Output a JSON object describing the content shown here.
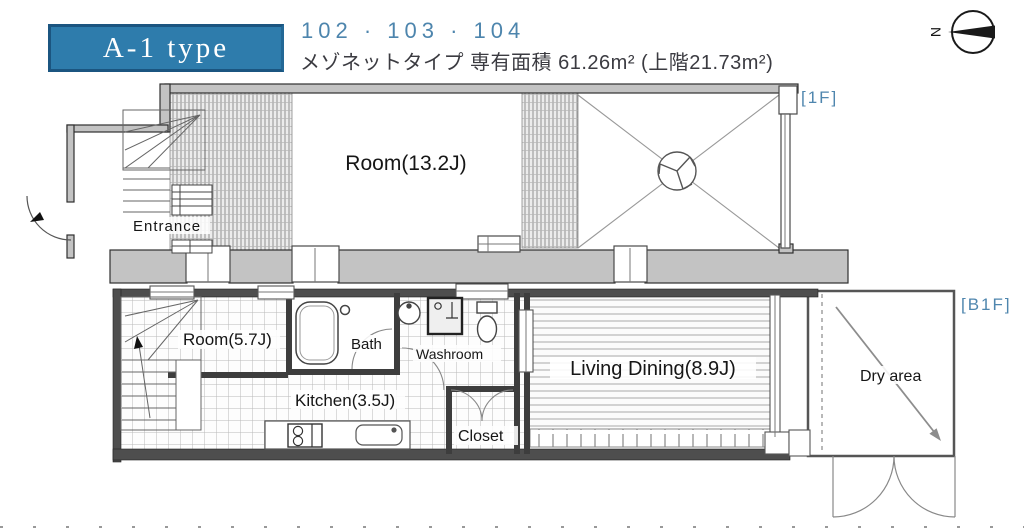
{
  "header": {
    "type_label": "A-1 type",
    "unit_numbers": "102 · 103 · 104",
    "subtitle": "メゾネットタイプ 専有面積 61.26m² (上階21.73m²)",
    "accent_color": "#2e7cac",
    "unit_color": "#4d85ad"
  },
  "compass": {
    "north_label": "N"
  },
  "floor_1f": {
    "tag": "[1F]",
    "rooms": {
      "entrance": "Entrance",
      "room": "Room(13.2J)"
    }
  },
  "floor_b1f": {
    "tag": "[B1F]",
    "rooms": {
      "room": "Room(5.7J)",
      "bath": "Bath",
      "washroom": "Washroom",
      "kitchen": "Kitchen(3.5J)",
      "living_dining": "Living Dining(8.9J)",
      "closet": "Closet",
      "dry_area": "Dry area"
    }
  }
}
